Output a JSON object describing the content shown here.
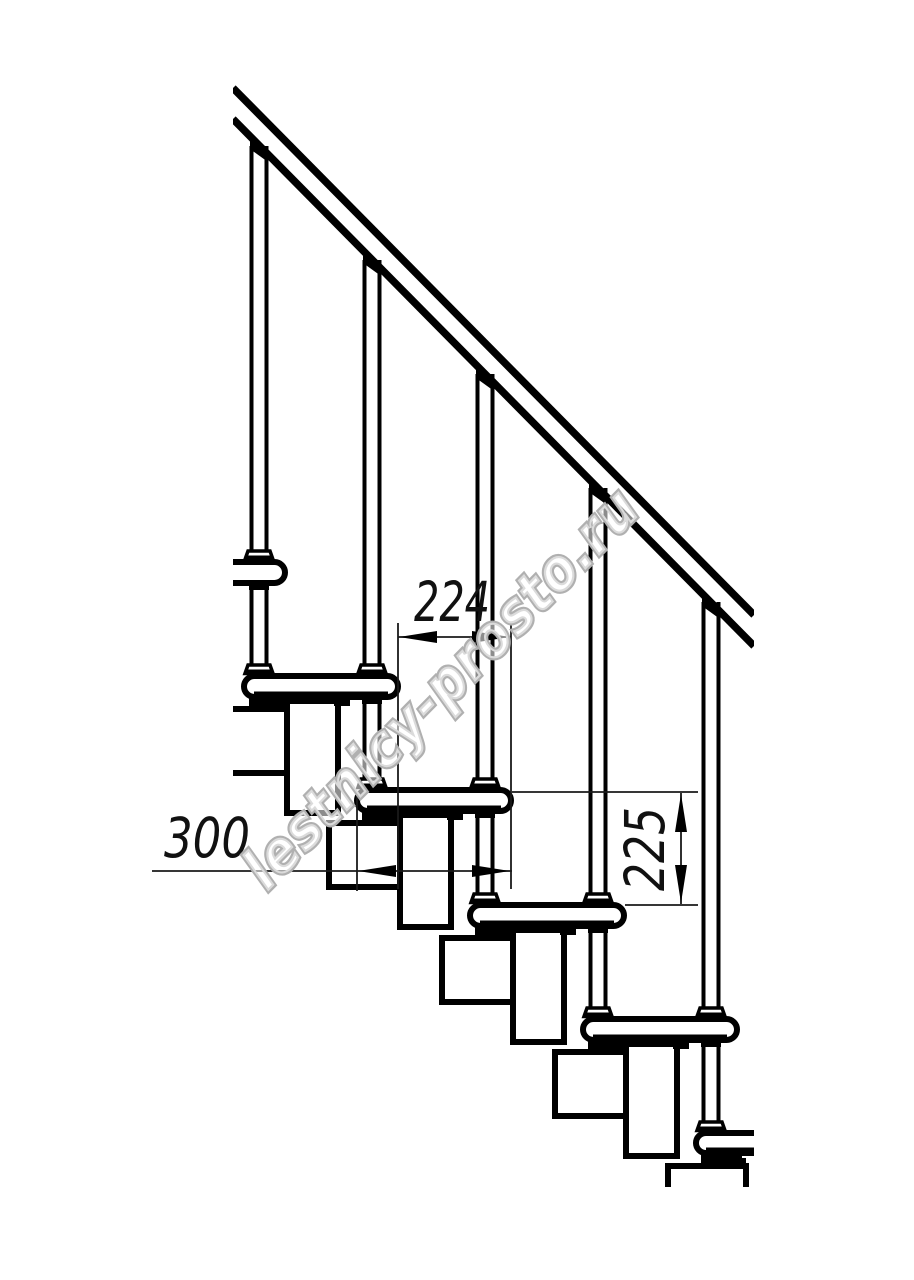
{
  "drawing": {
    "kind": "modular staircase side elevation",
    "colors": {
      "line": "#000000",
      "background": "#ffffff",
      "dimension_line": "#1a1a1a",
      "watermark_outline": "#b0b0b0"
    },
    "dimensions": {
      "step_run": {
        "label": "224",
        "value": 224,
        "orientation": "horizontal"
      },
      "tread_depth": {
        "label": "300",
        "value": 300,
        "orientation": "horizontal"
      },
      "riser_height": {
        "label": "225",
        "value": 225,
        "orientation": "vertical"
      }
    },
    "watermark": {
      "text": "lestnicy-prosto.ru"
    }
  }
}
